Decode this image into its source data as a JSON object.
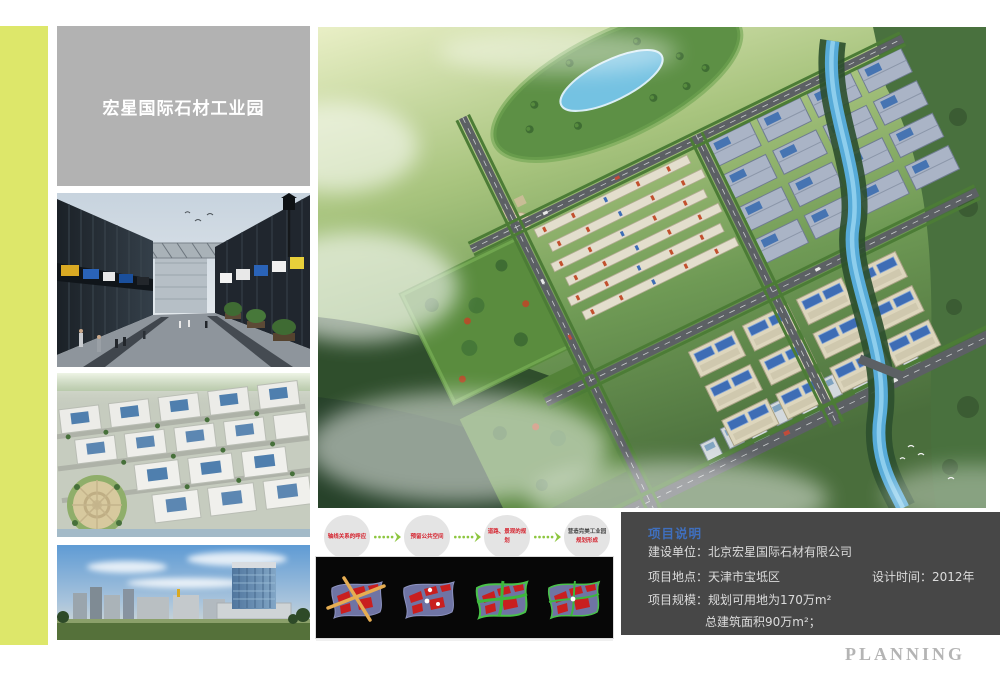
{
  "board": {
    "title": "宏星国际石材工业园",
    "watermark": "PLANNING"
  },
  "colors": {
    "accent_stripe": "#dde76a",
    "title_box_bg": "#b2b2b2",
    "info_box_bg": "#474747",
    "info_heading_blue": "#3f6fbe",
    "flow_text_red": "#d5232e",
    "flow_arrow_green": "#8dc63f",
    "diagram_panel_bg": "#070707"
  },
  "flow": {
    "arrow_icon": "dashed-arrow-right",
    "steps": [
      {
        "label": "轴线关系的呼应"
      },
      {
        "label": "预留公共空间"
      },
      {
        "label": "道路、景观的规划"
      },
      {
        "label": "营造完美工业园",
        "label2": "规划形成"
      }
    ]
  },
  "diagrams": {
    "items": [
      {
        "name": "axis-cross-analysis"
      },
      {
        "name": "public-space-nodes-analysis"
      },
      {
        "name": "road-landscape-network-analysis"
      },
      {
        "name": "final-plan-formation"
      }
    ]
  },
  "renderings": {
    "street_view": "street-view-rendering",
    "aerial_view": "aerial-view-rendering",
    "skyline_view": "skyline-rendering",
    "master_plan": "master-plan-aerial-rendering"
  },
  "info": {
    "heading": "项目说明",
    "owner": "建设单位：北京宏星国际石材有限公司",
    "location": "项目地点：天津市宝坻区",
    "design_time": "设计时间：2012年",
    "scale": "项目规模：规划可用地为170万m²",
    "area": "总建筑面积90万m²；"
  }
}
